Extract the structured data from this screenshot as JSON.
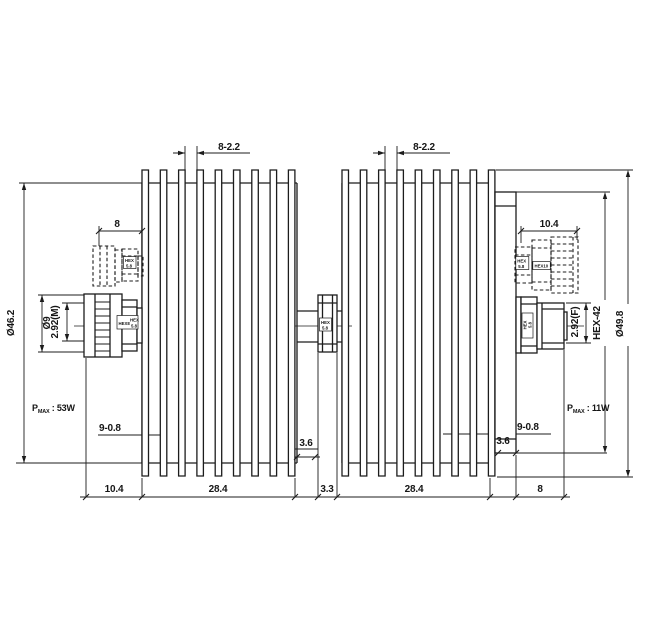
{
  "drawing": {
    "type": "technical-dimension-drawing",
    "subject": "dual heatsink RF attenuator side view",
    "colors": {
      "background": "#ffffff",
      "line": "#1c1c1c"
    },
    "dims": {
      "fin_slot_left": "8-2.2",
      "fin_slot_right": "8-2.2",
      "conn_top_left": "8",
      "conn_top_right": "10.4",
      "dia_left": "Ø46.2",
      "pin_dia": "Ø9",
      "iface_left": "2.92(M)",
      "iface_right": "2.92(F)",
      "hex_flats": "HEX-42",
      "dia_right": "Ø49.8",
      "fins_left": "9-0.8",
      "fins_right": "9-0.8",
      "step_left": "3.6",
      "step_right": "3.6",
      "chain": {
        "c1": "10.4",
        "c2": "28.4",
        "c3": "3.3",
        "c4": "28.4",
        "c5": "8"
      },
      "power_left": {
        "p": "P",
        "sub": "MAX",
        "val": " : 53W"
      },
      "power_right": {
        "p": "P",
        "sub": "MAX",
        "val": " : 11W"
      }
    },
    "hex": {
      "dl1": "HEX",
      "dl2": "5.8",
      "sl_a": "HEX8",
      "sl_b1": "HEX",
      "sl_b2": "5.8",
      "c1": "HEX",
      "c2": "5.8",
      "sr1": "HEX",
      "sr2": "5.8",
      "dr_a1": "HEX",
      "dr_a2": "5.8",
      "dr_b": "HEX10"
    }
  }
}
